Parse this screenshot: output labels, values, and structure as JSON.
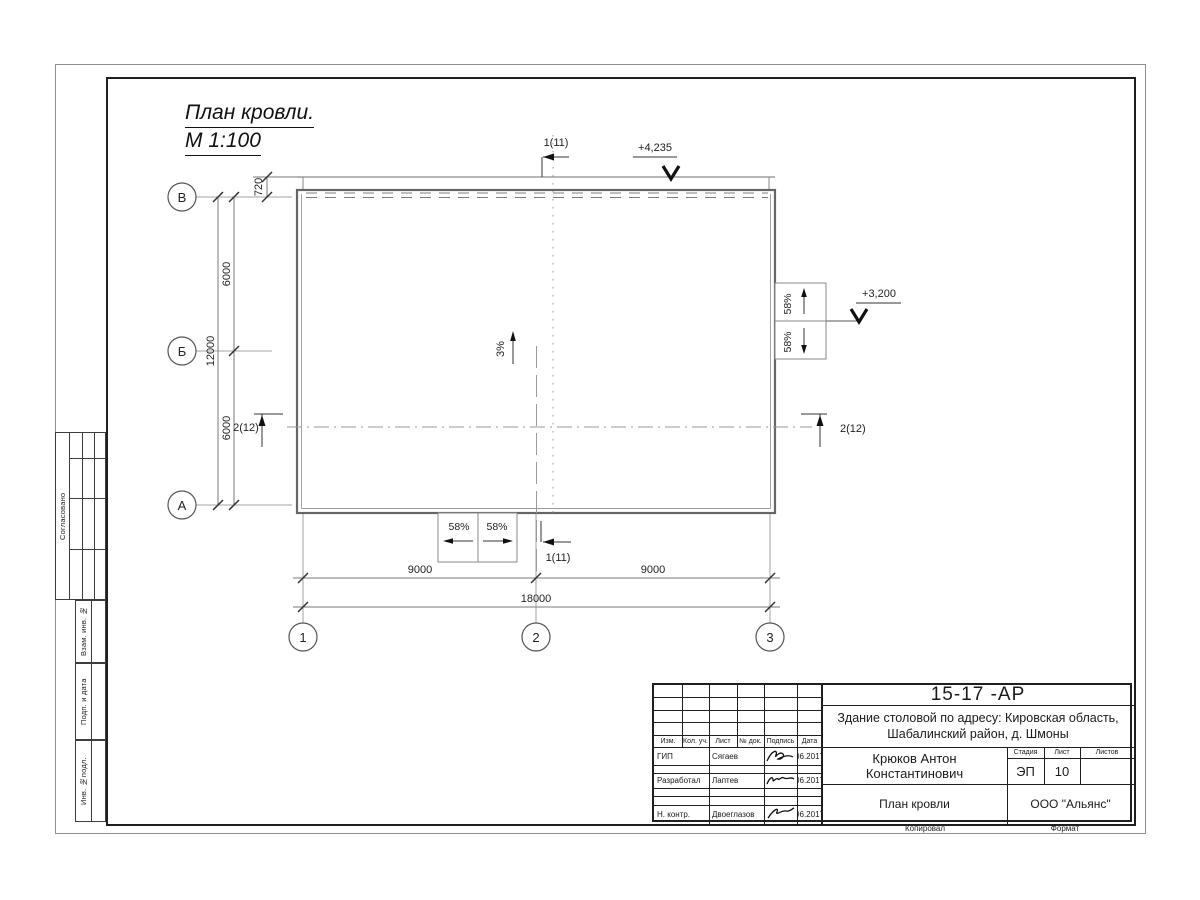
{
  "drawing": {
    "title_line1": "План кровли.",
    "title_line2": "М 1:100",
    "row_axes": [
      "В",
      "Б",
      "А"
    ],
    "col_axes": [
      "1",
      "2",
      "3"
    ],
    "dims": {
      "v720": "720",
      "v6000_top": "6000",
      "v6000_bottom": "6000",
      "v12000": "12000",
      "h9000_left": "9000",
      "h9000_right": "9000",
      "h18000": "18000"
    },
    "elevations": {
      "roof_top": "+4,235",
      "canopy": "+3,200"
    },
    "section_marks": {
      "top": "1(11)",
      "bottom": "1(11)",
      "left": "2(12)",
      "right": "2(12)"
    },
    "slopes": {
      "main": "3%",
      "right_upper": "58%",
      "right_lower": "58%",
      "bottom_left": "58%",
      "bottom_right": "58%"
    }
  },
  "frame_labels": {
    "agreed": "Согласовано",
    "vzam": "Взам. инв. №",
    "podp": "Подп. и дата",
    "inv": "Инв. №подл."
  },
  "title_block": {
    "doc_number": "15-17 -АР",
    "project_name_line1": "Здание столовой по адресу: Кировская область,",
    "project_name_line2": "Шабалинский район, д. Шмоны",
    "cols": [
      "Изм.",
      "Кол. уч.",
      "Лист",
      "№ док.",
      "Подпись",
      "Дата"
    ],
    "rows": [
      {
        "role": "ГИП",
        "name": "Сягаев",
        "date": "06.2017"
      },
      {
        "role": "Разработал",
        "name": "Лаптев",
        "date": "06.2017"
      },
      {
        "role": "Н. контр.",
        "name": "Двоеглазов",
        "date": "06.2017"
      }
    ],
    "author": "Крюков Антон Константинович",
    "stage_cols": [
      "Стадия",
      "Лист",
      "Листов"
    ],
    "stage": "ЭП",
    "sheet": "10",
    "sheet_count": "",
    "sheet_title": "План кровли",
    "company": "ООО \"Альянс\"",
    "copied_label": "Копировал",
    "format_label": "Формат"
  }
}
